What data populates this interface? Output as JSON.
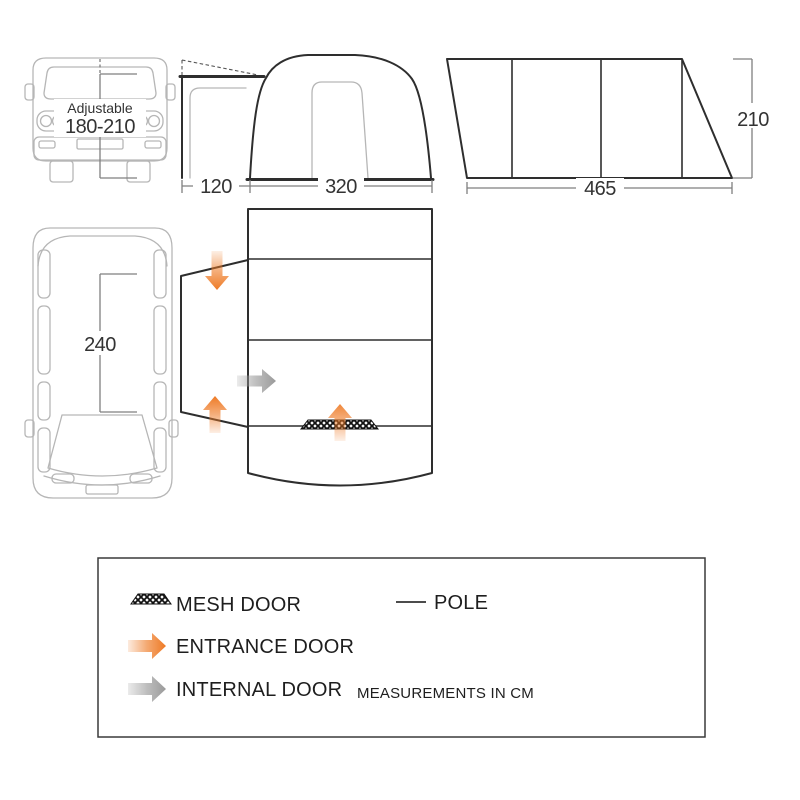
{
  "front_view": {
    "adjustable_label": "Adjustable",
    "adjustable_range": "180-210",
    "tunnel_width": "120",
    "awning_width": "320"
  },
  "side_view": {
    "length": "465",
    "height": "210"
  },
  "top_view": {
    "van_length": "240"
  },
  "legend": {
    "mesh_door": "MESH DOOR",
    "pole": "POLE",
    "entrance_door": "ENTRANCE DOOR",
    "internal_door": "INTERNAL DOOR",
    "note": "MEASUREMENTS IN CM",
    "icons": {
      "mesh": "mesh-hatch-swatch",
      "pole": "line-swatch",
      "entrance": "orange-arrow",
      "internal": "gray-arrow"
    }
  },
  "colors": {
    "entrance_orange": "#ee7a25",
    "internal_gray": "#9a9a9a",
    "outline_dark": "#2e2e2e",
    "van_gray": "#b6b6b6",
    "dimension_gray": "#7f7f7f"
  }
}
